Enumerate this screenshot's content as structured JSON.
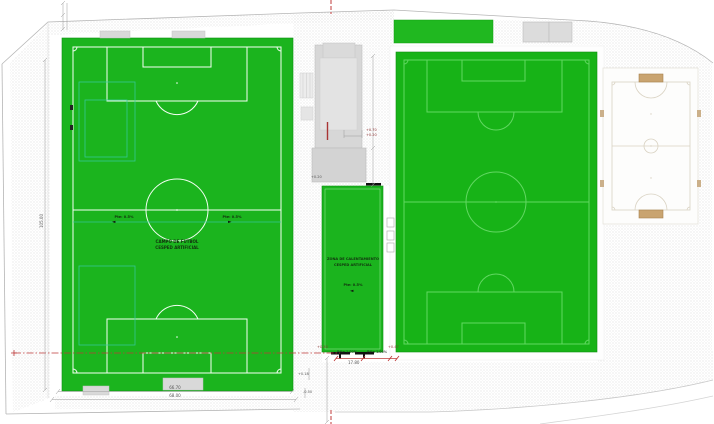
{
  "plan": {
    "fields": {
      "main_field": {
        "label_line1": "CAMPO DE FUTBOL",
        "label_line2": "CESPED ARTIFICIAL",
        "slope_left": "Pte: 0.5%",
        "slope_left_arrow": "◄",
        "slope_right": "Pte: 0.5%",
        "slope_right_arrow": "►"
      },
      "warmup_field": {
        "label_line1": "ZONA DE CALENTAMIENTO",
        "label_line2": "CESPED ARTIFICIAL",
        "slope": "Pte: 0.5%",
        "slope_arrow": "◄"
      }
    },
    "dimensions": {
      "main_field_width_inner": "66.70",
      "main_field_width_outer": "68.00",
      "main_field_length": "105.00",
      "corridor_width": "17.80"
    },
    "slope_notes": {
      "note1": "Pdte 1.00%",
      "note2": "Pdte 1.00%"
    },
    "levels": {
      "corridor_west": "+0.20",
      "corridor_east": "+0.47",
      "building_upper": "+0.70",
      "building_lower": "+0.20",
      "plaza_a": "+0.18",
      "plaza_b": "-0.50",
      "building_side": "+0.20"
    },
    "colors": {
      "pitch_green": "#1bb41e",
      "pitch_line_white": "#f4fff4",
      "secondary_line_green": "#62d862",
      "training_line_teal": "#38c9a2",
      "section_red": "#bf3a3a",
      "building_gray": "#d7d7d7",
      "court_tan": "#c9a470"
    }
  }
}
